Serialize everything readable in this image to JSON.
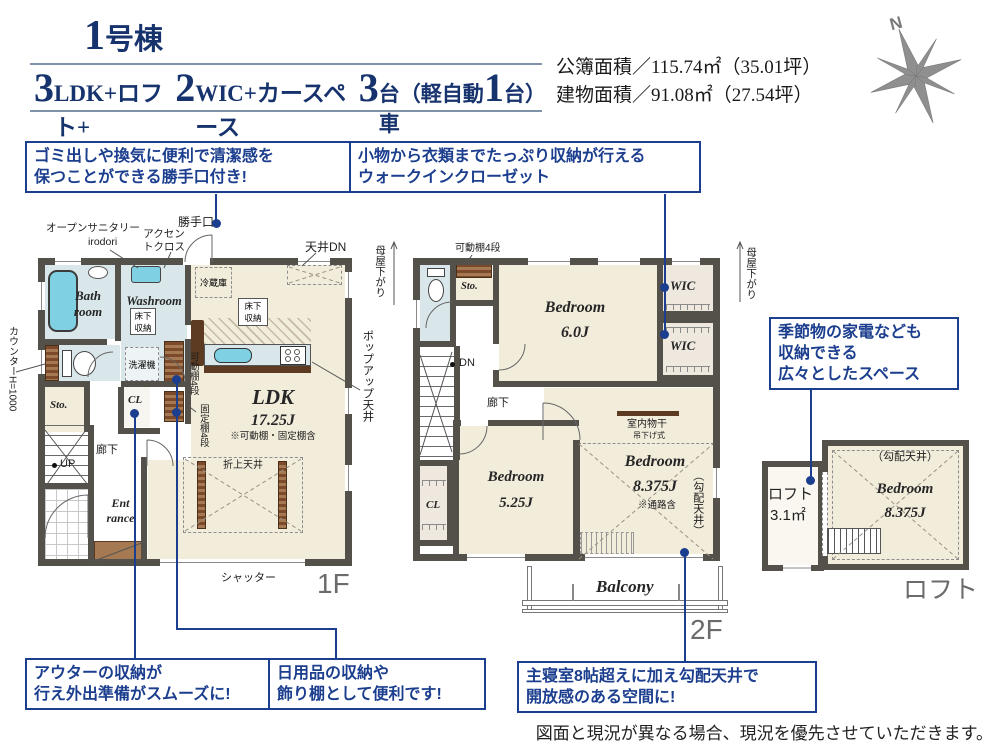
{
  "colors": {
    "navy": "#1c3e8e",
    "header_navy": "#17336e",
    "wall": "#54514a",
    "beige": "#f2ecdb",
    "water": "#d9e7ea",
    "fixture": "#7ed0e2",
    "wood": "#7c4a2a",
    "wood_light": "#a57a52"
  },
  "header": {
    "building_num": "1",
    "building_suffix": "号棟",
    "spec": [
      {
        "t": "3"
      },
      {
        "t": "LDK+ロフト+"
      },
      {
        "t": "2"
      },
      {
        "t": "WIC+カースペース"
      },
      {
        "t": "3"
      },
      {
        "t": "台（軽自動車"
      },
      {
        "t": "1"
      },
      {
        "t": "台）"
      }
    ],
    "area1": "公簿面積／115.74㎡（35.01坪）",
    "area2": "建物面積／91.08㎡（27.54坪）",
    "compass": "N"
  },
  "callouts": {
    "c1": "ゴミ出しや換気に便利で清潔感を\n保つことができる勝手口付き!",
    "c2": "小物から衣類までたっぷり収納が行える\nウォークインクローゼット",
    "c3": "季節物の家電なども\n収納できる\n広々としたスペース",
    "c4": "アウターの収納が\n行え外出準備がスムーズに!",
    "c5": "日用品の収納や\n飾り棚として便利です!",
    "c6": "主寝室8帖超えに加え勾配天井で\n開放感のある空間に!"
  },
  "f1": {
    "katteguchi": "勝手口",
    "sanitary1": "オープンサニタリー",
    "sanitary2": "irodori",
    "accent": "アクセン\nトクロス",
    "ceiling_dn": "天井DN",
    "bath": "Bath\nroom",
    "washroom": "Washroom",
    "underfloor1": "床下\n収納",
    "washer": "洗濯機",
    "fridge": "冷蔵庫",
    "underfloor2": "床下\n収納",
    "counter": "カウンターH=1000",
    "sto": "Sto.",
    "cl": "CL",
    "shelf_mov": "可動棚4段",
    "shelf_fix": "固定棚4段",
    "hall": "廊下",
    "up": "UP",
    "entrance": "Ent\nrance",
    "ldk": "LDK",
    "ldk_size": "17.25J",
    "ldk_note": "※可動棚・固定棚含",
    "oriage": "折上天井",
    "popup": "ポップアップ天井",
    "shutter": "シャッター",
    "floor": "1F"
  },
  "f2": {
    "moya": "母屋下がり",
    "shelf": "可動棚4段",
    "sto": "Sto.",
    "bed1": "Bedroom",
    "bed1_size": "6.0J",
    "wic": "WIC",
    "dn": "DN",
    "hall": "廊下",
    "cl": "CL",
    "bed2": "Bedroom",
    "bed2_size": "5.25J",
    "bed3": "Bedroom",
    "bed3_size": "8.375J",
    "bed3_note": "※通路含",
    "laundry": "室内物干",
    "laundry_sub": "吊下げ式",
    "slope": "（勾配天井）",
    "balcony": "Balcony",
    "floor": "2F"
  },
  "loft": {
    "name": "ロフト",
    "size": "3.1㎡",
    "slope": "（勾配天井）",
    "bed": "Bedroom",
    "bed_size": "8.375J",
    "floor": "ロフト"
  },
  "footer": "図面と現況が異なる場合、現況を優先させていただきます。"
}
